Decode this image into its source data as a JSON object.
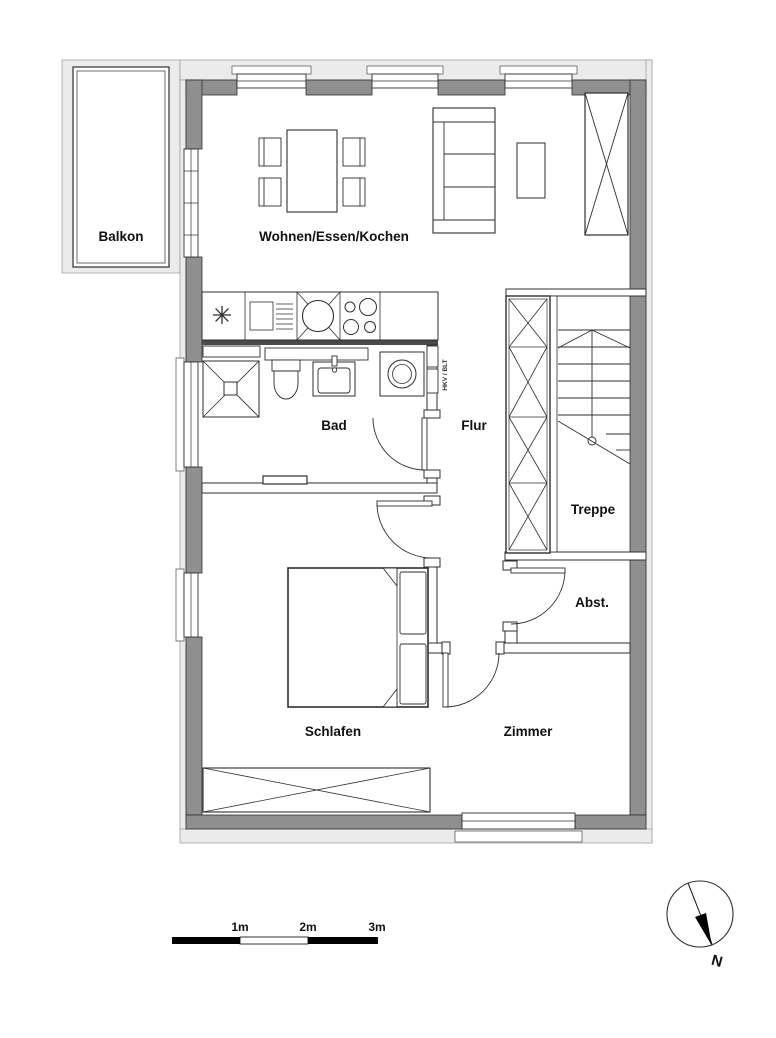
{
  "rooms": [
    {
      "id": "balkon",
      "label": "Balkon"
    },
    {
      "id": "wohnen",
      "label": "Wohnen/Essen/Kochen"
    },
    {
      "id": "bad",
      "label": "Bad"
    },
    {
      "id": "flur",
      "label": "Flur"
    },
    {
      "id": "treppe",
      "label": "Treppe"
    },
    {
      "id": "abst",
      "label": "Abst."
    },
    {
      "id": "schlafen",
      "label": "Schlafen"
    },
    {
      "id": "zimmer",
      "label": "Zimmer"
    }
  ],
  "annotations": {
    "shaft_label": "HKV / BLT"
  },
  "scale_bar": {
    "ticks": [
      "1m",
      "2m",
      "3m"
    ]
  },
  "compass": {
    "north_label": "N"
  },
  "colors": {
    "exterior_wall": "#8f8f8f",
    "outer_band": "#ebebeb",
    "interior_wall_fill": "#ffffff",
    "line": "#2f2f2f",
    "text": "#111111",
    "scale_black": "#000000"
  }
}
